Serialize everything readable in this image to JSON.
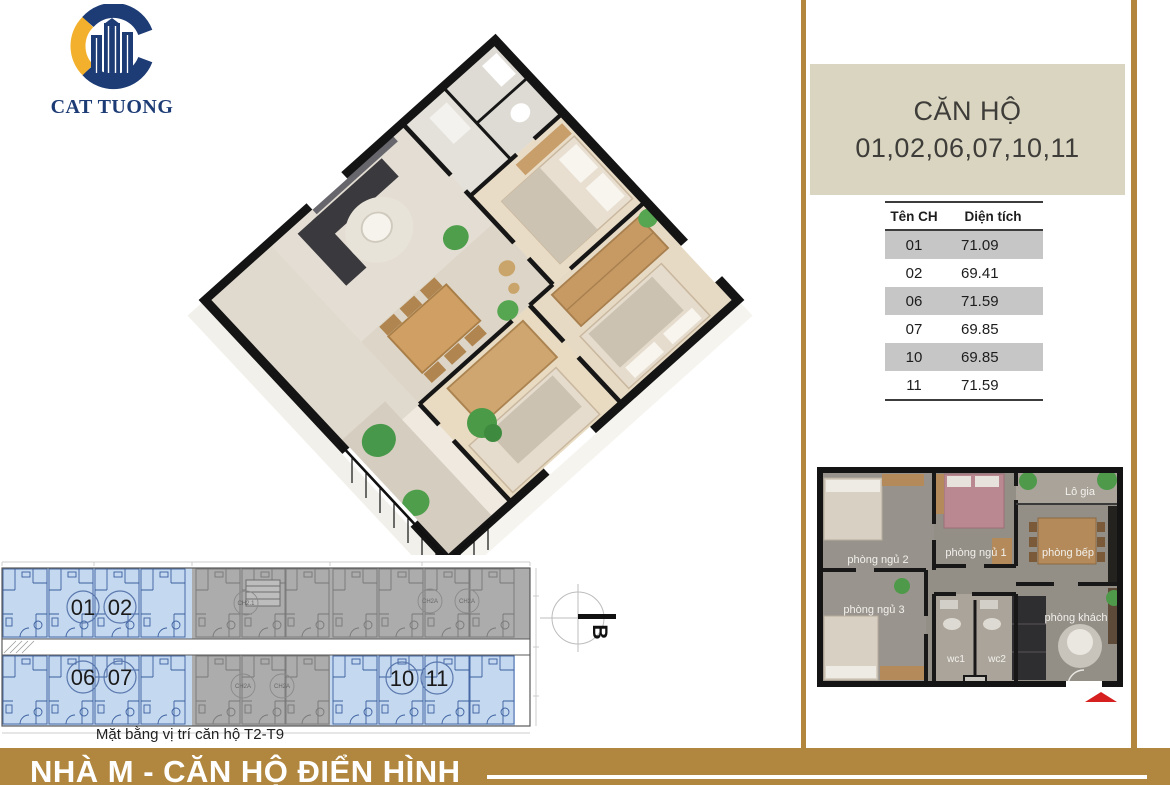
{
  "logo": {
    "text": "CAT TUONG"
  },
  "panel": {
    "title_line1": "CĂN HỘ",
    "title_line2": "01,02,06,07,10,11",
    "table": {
      "headers": [
        "Tên CH",
        "Diện tích"
      ],
      "rows": [
        [
          "01",
          "71.09"
        ],
        [
          "02",
          "69.41"
        ],
        [
          "06",
          "71.59"
        ],
        [
          "07",
          "69.85"
        ],
        [
          "10",
          "69.85"
        ],
        [
          "11",
          "71.59"
        ]
      ]
    }
  },
  "unit_plan": {
    "rooms": {
      "bedroom2": "phòng ngủ 2",
      "bedroom1": "phòng ngủ 1",
      "kitchen": "phòng bếp",
      "loggia": "Lô gia",
      "bedroom3": "phòng ngủ 3",
      "wc1": "wc1",
      "wc2": "wc2",
      "living": "phòng khách"
    }
  },
  "site_plan": {
    "caption": "Mặt bằng vị trí căn hộ T2-T9",
    "highlighted_units": [
      "01",
      "02",
      "06",
      "07",
      "10",
      "11"
    ],
    "gray_units": [
      "CH2.1",
      "CH2A"
    ],
    "compass_label": "B"
  },
  "footer": {
    "title": "NHÀ M - CĂN HỘ ĐIỂN HÌNH"
  },
  "colors": {
    "gold_line": "#b2863c",
    "banner_gold": "#b1873f",
    "title_beige": "#d9d5c0",
    "table_gray": "#c6c6c6",
    "logo_navy": "#1d3c75",
    "logo_gold": "#f3b02c",
    "plan_blue_fill": "#c4d8f0",
    "plan_blue_line": "#3a5f9e",
    "plan_gray_fill": "#acacac",
    "entry_arrow_red": "#d61f1f"
  }
}
